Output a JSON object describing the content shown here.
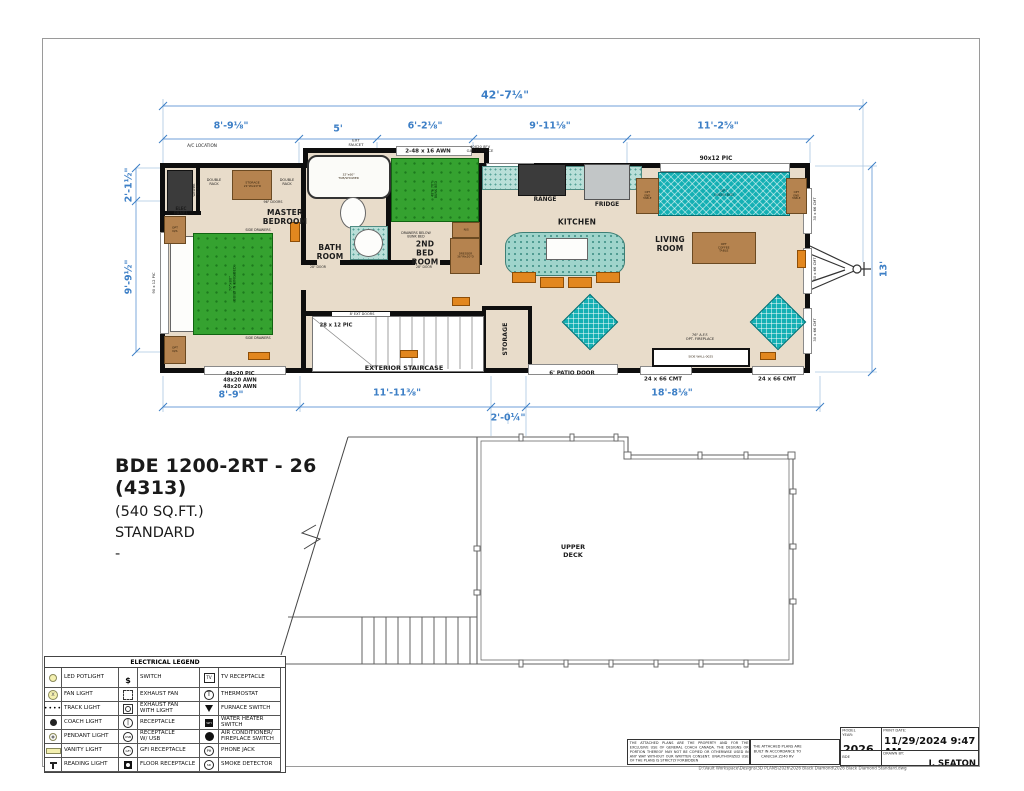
{
  "project": {
    "title": "BDE 1200-2RT - 26 (4313)",
    "subtitle": "(540 SQ.FT.)\nSTANDARD\n-"
  },
  "colors": {
    "dimension_blue": "#3d7fc6",
    "floor_tan": "#e8dcca",
    "bed_green": "#35a230",
    "teal": "#14b0b4",
    "cabinet_brown": "#b5834f",
    "wall_black": "#0e0e0e"
  },
  "dimensions": [
    {
      "name": "overall-width",
      "text": "42'-7¼\"",
      "x": 505,
      "y": 95,
      "cls": "dim-lg"
    },
    {
      "name": "seg-master",
      "text": "8'-9⅛\"",
      "x": 231,
      "y": 126
    },
    {
      "name": "seg-bath",
      "text": "5'",
      "x": 338,
      "y": 129
    },
    {
      "name": "seg-2ndbed",
      "text": "6'-2⅛\"",
      "x": 425,
      "y": 126
    },
    {
      "name": "seg-kitchen",
      "text": "9'-11⅛\"",
      "x": 550,
      "y": 126
    },
    {
      "name": "seg-living",
      "text": "11'-2⅝\"",
      "x": 718,
      "y": 126
    },
    {
      "name": "left-closet",
      "text": "2'-1½\"",
      "x": 129,
      "y": 185,
      "rot": -90
    },
    {
      "name": "left-master",
      "text": "9'-9½\"",
      "x": 129,
      "y": 277,
      "rot": -90
    },
    {
      "name": "right-height",
      "text": "13'",
      "x": 884,
      "y": 269,
      "rot": -90
    },
    {
      "name": "bot-master",
      "text": "8'-9\"",
      "x": 231,
      "y": 395
    },
    {
      "name": "bot-stairs",
      "text": "11'-11⅜\"",
      "x": 397,
      "y": 393
    },
    {
      "name": "bot-entry",
      "text": "2'-0¼\"",
      "x": 508,
      "y": 418
    },
    {
      "name": "bot-living",
      "text": "18'-8⅛\"",
      "x": 672,
      "y": 393
    }
  ],
  "plan_labels": [
    {
      "t": "MASTER\nBEDROOM",
      "x": 285,
      "y": 217,
      "cls": "room"
    },
    {
      "t": "BATH\nROOM",
      "x": 330,
      "y": 252,
      "cls": "room"
    },
    {
      "t": "2ND\nBED\nROOM",
      "x": 425,
      "y": 253,
      "cls": "room"
    },
    {
      "t": "KITCHEN",
      "x": 577,
      "y": 222,
      "cls": "room"
    },
    {
      "t": "LIVING\nROOM",
      "x": 670,
      "y": 244,
      "cls": "room"
    },
    {
      "t": "STORAGE",
      "x": 505,
      "y": 339,
      "cls": "room",
      "rot": -90,
      "s": 0.8
    },
    {
      "t": "EXTERIOR STAIRCASE",
      "x": 404,
      "y": 368,
      "cls": "bold"
    },
    {
      "t": "UPPER\nDECK",
      "x": 573,
      "y": 551,
      "cls": "bold"
    },
    {
      "t": "RANGE",
      "x": 545,
      "y": 199,
      "cls": "bold",
      "s": 0.9
    },
    {
      "t": "FRIDGE",
      "x": 607,
      "y": 204,
      "cls": "bold",
      "s": 0.9
    },
    {
      "t": "90x12 PIC",
      "x": 716,
      "y": 158,
      "cls": "bold",
      "s": 0.9
    },
    {
      "t": "2-48 x 16 AWN",
      "x": 428,
      "y": 151,
      "cls": "bold",
      "s": 0.85
    },
    {
      "t": "40X20 8FV\nGAS FURNACE",
      "x": 480,
      "y": 149,
      "cls": "tiny",
      "s": 0.62
    },
    {
      "t": "EXT\nFAUCET",
      "x": 356,
      "y": 143,
      "cls": "tiny",
      "s": 0.65
    },
    {
      "t": "A/C LOCATION",
      "x": 202,
      "y": 146,
      "cls": "tiny",
      "s": 0.7
    },
    {
      "t": "6' PATIO DOOR",
      "x": 572,
      "y": 373,
      "cls": "bold",
      "s": 0.85
    },
    {
      "t": "24 x 66 CMT",
      "x": 663,
      "y": 379,
      "cls": "bold",
      "s": 0.85
    },
    {
      "t": "24 x 66 CMT",
      "x": 777,
      "y": 379,
      "cls": "bold",
      "s": 0.85
    },
    {
      "t": "48x20 PIC\n48x20 AWN\n48x20 AWN",
      "x": 240,
      "y": 380,
      "cls": "bold",
      "s": 0.8
    },
    {
      "t": "28 x 12 PIC",
      "x": 336,
      "y": 325,
      "cls": "bold",
      "s": 0.8
    },
    {
      "t": "8' EXT DOORS",
      "x": 362,
      "y": 314,
      "cls": "tiny",
      "s": 0.58
    },
    {
      "t": "30 x 66 CMT",
      "x": 815,
      "y": 209,
      "cls": "tiny",
      "rot": -90,
      "s": 0.62
    },
    {
      "t": "30 x 66 CMT",
      "x": 815,
      "y": 269,
      "cls": "tiny",
      "rot": -90,
      "s": 0.62
    },
    {
      "t": "30 x 66 CMT",
      "x": 815,
      "y": 330,
      "cls": "tiny",
      "rot": -90,
      "s": 0.62
    },
    {
      "t": "90 x 12 PIC",
      "x": 154,
      "y": 283,
      "cls": "tiny",
      "rot": -90,
      "s": 0.62
    },
    {
      "t": "ELEC\nPANEL",
      "x": 181,
      "y": 211,
      "cls": "bold",
      "s": 0.62
    },
    {
      "t": "DOUBLE\nRACK",
      "x": 214,
      "y": 182,
      "cls": "tiny",
      "s": 0.58
    },
    {
      "t": "DOUBLE\nRACK",
      "x": 287,
      "y": 182,
      "cls": "tiny",
      "s": 0.58
    },
    {
      "t": "96\" DOORS",
      "x": 273,
      "y": 202,
      "cls": "tiny",
      "s": 0.55
    },
    {
      "t": "SIDE DRAWERS",
      "x": 258,
      "y": 230,
      "cls": "tiny",
      "s": 0.55
    },
    {
      "t": "SIDE DRAWERS",
      "x": 258,
      "y": 338,
      "cls": "tiny",
      "s": 0.55
    },
    {
      "t": "WASHER\nDRYER",
      "x": 196,
      "y": 190,
      "cls": "tiny",
      "rot": -90,
      "s": 0.5
    },
    {
      "t": "DRAWERS BELOW\nBUNK BED",
      "x": 416,
      "y": 235,
      "cls": "tiny",
      "s": 0.55
    },
    {
      "t": "28\" DOOR",
      "x": 318,
      "y": 267,
      "cls": "tiny",
      "s": 0.52
    },
    {
      "t": "28\" DOOR",
      "x": 424,
      "y": 267,
      "cls": "tiny",
      "s": 0.52
    },
    {
      "t": "76\" A.F.F.\nOPT. FIREPLACE",
      "x": 700,
      "y": 337,
      "cls": "tiny",
      "s": 0.6
    }
  ],
  "furniture": [
    {
      "type": "white",
      "x": 170,
      "y": 236,
      "w": 22,
      "h": 94
    },
    {
      "type": "green",
      "x": 193,
      "y": 233,
      "w": 78,
      "h": 100,
      "label": "70\"x80\"\nBUILT IN KING BED",
      "lrot": -90,
      "s": 0.62
    },
    {
      "type": "dark",
      "x": 167,
      "y": 170,
      "w": 24,
      "h": 40
    },
    {
      "type": "brown",
      "x": 232,
      "y": 170,
      "w": 38,
      "h": 28,
      "label": "STORAGE\n21\"Wx20\"D",
      "s": 0.5
    },
    {
      "type": "brown",
      "x": 164,
      "y": 216,
      "w": 20,
      "h": 26,
      "label": "OPT\nN/S",
      "s": 0.5
    },
    {
      "type": "brown",
      "x": 164,
      "y": 336,
      "w": 20,
      "h": 26,
      "label": "OPT\nN/S",
      "s": 0.5
    },
    {
      "type": "tub",
      "x": 307,
      "y": 155,
      "w": 80,
      "h": 40,
      "label": "32\"x60\"\nTUB/SHOWER",
      "s": 0.5
    },
    {
      "type": "whiter",
      "x": 340,
      "y": 197,
      "w": 24,
      "h": 30
    },
    {
      "type": "counter",
      "x": 350,
      "y": 226,
      "w": 36,
      "h": 32
    },
    {
      "type": "whiter",
      "x": 354,
      "y": 229,
      "w": 27,
      "h": 26
    },
    {
      "type": "green",
      "x": 391,
      "y": 158,
      "w": 86,
      "h": 62,
      "label": "48\"x 76\"\nBUNK BED",
      "lrot": -90,
      "s": 0.55
    },
    {
      "type": "brown",
      "x": 452,
      "y": 222,
      "w": 26,
      "h": 14,
      "label": "N/S",
      "s": 0.5
    },
    {
      "type": "brown",
      "x": 450,
      "y": 238,
      "w": 28,
      "h": 34,
      "label": "DRESSER\n36\"Wx20\"D",
      "s": 0.48
    },
    {
      "type": "counter",
      "x": 482,
      "y": 166,
      "w": 158,
      "h": 22
    },
    {
      "type": "dark",
      "x": 518,
      "y": 164,
      "w": 46,
      "h": 30
    },
    {
      "type": "gray",
      "x": 584,
      "y": 164,
      "w": 44,
      "h": 34
    },
    {
      "type": "island",
      "x": 505,
      "y": 232,
      "w": 118,
      "h": 42
    },
    {
      "type": "white",
      "x": 546,
      "y": 238,
      "w": 40,
      "h": 20
    },
    {
      "type": "orange",
      "x": 512,
      "y": 272,
      "w": 22,
      "h": 9
    },
    {
      "type": "orange",
      "x": 540,
      "y": 277,
      "w": 22,
      "h": 9
    },
    {
      "type": "orange",
      "x": 568,
      "y": 277,
      "w": 22,
      "h": 9
    },
    {
      "type": "orange",
      "x": 596,
      "y": 272,
      "w": 22,
      "h": 9
    },
    {
      "type": "tealx",
      "x": 658,
      "y": 172,
      "w": 130,
      "h": 42,
      "label": "OPT\nQUEEN BED",
      "s": 0.55
    },
    {
      "type": "brown",
      "x": 636,
      "y": 178,
      "w": 21,
      "h": 34,
      "label": "OPT\nEND\nTABLE",
      "s": 0.45
    },
    {
      "type": "brown",
      "x": 786,
      "y": 178,
      "w": 19,
      "h": 34,
      "label": "OPT\nEND\nTABLE",
      "s": 0.45
    },
    {
      "type": "brown",
      "x": 692,
      "y": 232,
      "w": 62,
      "h": 30,
      "label": "OPT\nCOFFEE\nTABLE",
      "s": 0.5
    },
    {
      "type": "tealx",
      "x": 570,
      "y": 302,
      "w": 38,
      "h": 38,
      "rot": 45
    },
    {
      "type": "tealx",
      "x": 758,
      "y": 302,
      "w": 38,
      "h": 38,
      "rot": 45
    },
    {
      "type": "wbox",
      "x": 652,
      "y": 348,
      "w": 94,
      "h": 15,
      "label": "SIDE WALL-0025",
      "s": 0.5
    },
    {
      "type": "orange",
      "x": 290,
      "y": 222,
      "w": 8,
      "h": 18
    },
    {
      "type": "orange",
      "x": 248,
      "y": 352,
      "w": 20,
      "h": 6
    },
    {
      "type": "orange",
      "x": 400,
      "y": 350,
      "w": 16,
      "h": 6
    },
    {
      "type": "orange",
      "x": 452,
      "y": 297,
      "w": 16,
      "h": 7
    },
    {
      "type": "orange",
      "x": 760,
      "y": 352,
      "w": 14,
      "h": 6
    },
    {
      "type": "orange",
      "x": 797,
      "y": 250,
      "w": 7,
      "h": 16
    }
  ],
  "legend": {
    "title": "ELECTRICAL LEGEND",
    "rows": [
      [
        {
          "icon": "led-potlight",
          "label": "LED POTLIGHT"
        },
        {
          "icon": "switch",
          "label": "SWITCH"
        },
        {
          "icon": "tv-receptacle",
          "label": "TV RECEPTACLE"
        }
      ],
      [
        {
          "icon": "fan-light",
          "label": "FAN LIGHT"
        },
        {
          "icon": "exhaust-fan",
          "label": "EXHAUST FAN"
        },
        {
          "icon": "thermostat",
          "label": "THERMOSTAT"
        }
      ],
      [
        {
          "icon": "track-light",
          "label": "TRACK LIGHT"
        },
        {
          "icon": "exhaust-fan-light",
          "label": "EXHAUST FAN\nWITH LIGHT"
        },
        {
          "icon": "furnace-switch",
          "label": "FURNACE SWITCH"
        }
      ],
      [
        {
          "icon": "coach-light",
          "label": "COACH LIGHT"
        },
        {
          "icon": "receptacle",
          "label": "RECEPTACLE"
        },
        {
          "icon": "water-heater-switch",
          "label": "WATER HEATER\nSWITCH"
        }
      ],
      [
        {
          "icon": "pendant-light",
          "label": "PENDANT LIGHT"
        },
        {
          "icon": "receptacle-usb",
          "label": "RECEPTACLE\nW/ USB"
        },
        {
          "icon": "ac-fireplace-switch",
          "label": "AIR CONDITIONER/\nFIREPLACE SWITCH"
        }
      ],
      [
        {
          "icon": "vanity-light",
          "label": "VANITY LIGHT"
        },
        {
          "icon": "gfi-receptacle",
          "label": "GFI RECEPTACLE"
        },
        {
          "icon": "phone-jack",
          "label": "PHONE JACK"
        }
      ],
      [
        {
          "icon": "reading-light",
          "label": "READING LIGHT"
        },
        {
          "icon": "floor-receptacle",
          "label": "FLOOR RECEPTACLE"
        },
        {
          "icon": "smoke-detector",
          "label": "SMOKE DETECTOR"
        }
      ]
    ]
  },
  "title_block": {
    "disclaimer": "THE ATTACHED PLANS ARE THE PROPERTY AND FOR THE EXCLUSIVE USE OF GENERAL COACH CANADA. THE DESIGNS OR PORTION THEREOF MAY NOT BE COPIED OR OTHERWISE USED IN ANY WAY WITHOUT OUR WRITTEN CONSENT. UNAUTHORIZED USE OF THE PLANS IS STRICTLY FORBIDDEN",
    "accordance": "THE ATTACHED PLANS ARE BUILT IN ACCORDANCE TO CAN/CSA Z240 RV",
    "model_year_label": "MODEL YEAR:",
    "model_year": "2026",
    "print_date_label": "PRINT DATE:",
    "print_date": "11/29/2024 9:47 AM",
    "model_code": "BDE",
    "drawn_by_label": "DRAWN BY:",
    "drawn_by": "J. SEATON",
    "file_path": "D:\\Vault Workspace\\Designs\\3D PLANS\\2026\\2026 Black Diamond\\2026 Black Diamond Standard.dwg"
  }
}
